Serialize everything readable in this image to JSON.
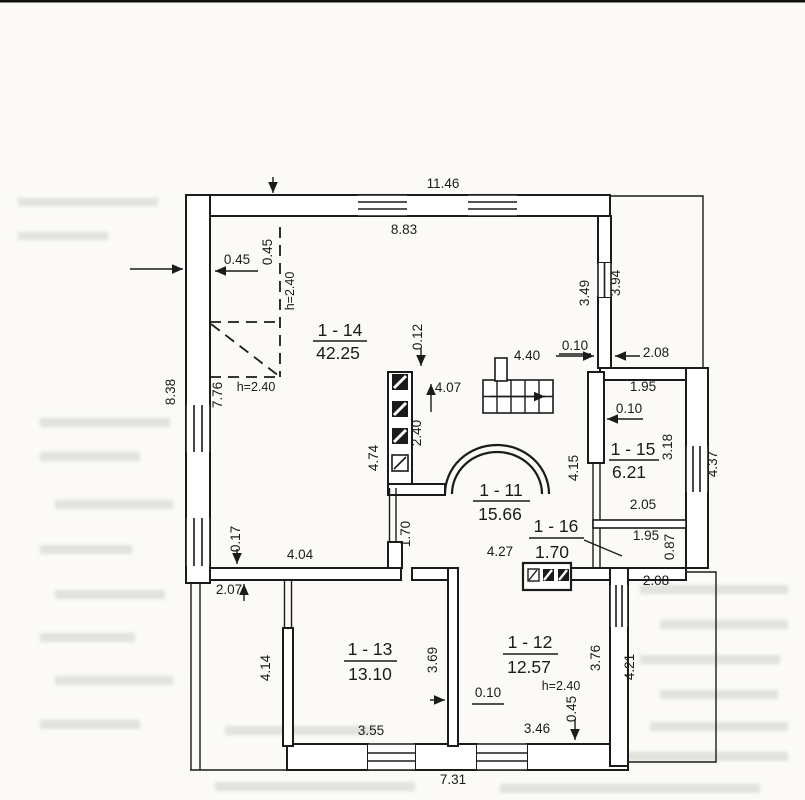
{
  "rooms": {
    "r14": {
      "no": "1 - 14",
      "area": "42.25"
    },
    "r11": {
      "no": "1 - 11",
      "area": "15.66"
    },
    "r15": {
      "no": "1 - 15",
      "area": "6.21"
    },
    "r16": {
      "no": "1 - 16",
      "area": "1.70"
    },
    "r13": {
      "no": "1 - 13",
      "area": "13.10"
    },
    "r12": {
      "no": "1 - 12",
      "area": "12.57"
    }
  },
  "dims": {
    "top_width_outer": "11.46",
    "top_width_inner": "8.83",
    "left_height_outer": "8.38",
    "left_height_inner": "7.76",
    "bottom_width": "7.31",
    "knee_inset_h": "0.45",
    "knee_inset_v": "0.45",
    "knee_height_upper": "h=2.40",
    "knee_height_lower": "h=2.40",
    "flue_top_offset": "0.12",
    "hall_depth": "4.07",
    "hall_width_top": "4.40",
    "gap_top": "0.10",
    "terrace_ne_width": "2.08",
    "wall_ne_inner": "3.49",
    "terrace_ne_height": "3.94",
    "r15_width_top": "1.95",
    "r15_wall": "0.10",
    "r15_height_inner": "3.18",
    "r15_window_height": "4.37",
    "r15_width_bottom": "2.05",
    "r16_width": "1.95",
    "r16_height": "0.87",
    "terrace_se_width": "2.08",
    "flue_wall_height": "2.40",
    "r14_side": "4.74",
    "hall_side": "4.15",
    "hall_width_bottom": "4.27",
    "corridor_height": "1.70",
    "wall_thickness": "0.17",
    "r14_width_bottom": "4.04",
    "open_area_height": "2.07",
    "r13_side": "4.14",
    "r13_divider": "3.69",
    "r13_width_bottom": "3.55",
    "r12_height_note": "h=2.40",
    "r12_side": "3.76",
    "terrace_se_height": "4.21",
    "r12_width_bottom": "3.46",
    "r12_pier": "0.45",
    "r12_wall": "0.10"
  },
  "colors": {
    "ink": "#1b1b1b",
    "paper": "#fbfaf6",
    "bleed_through": "#8f8f85"
  }
}
